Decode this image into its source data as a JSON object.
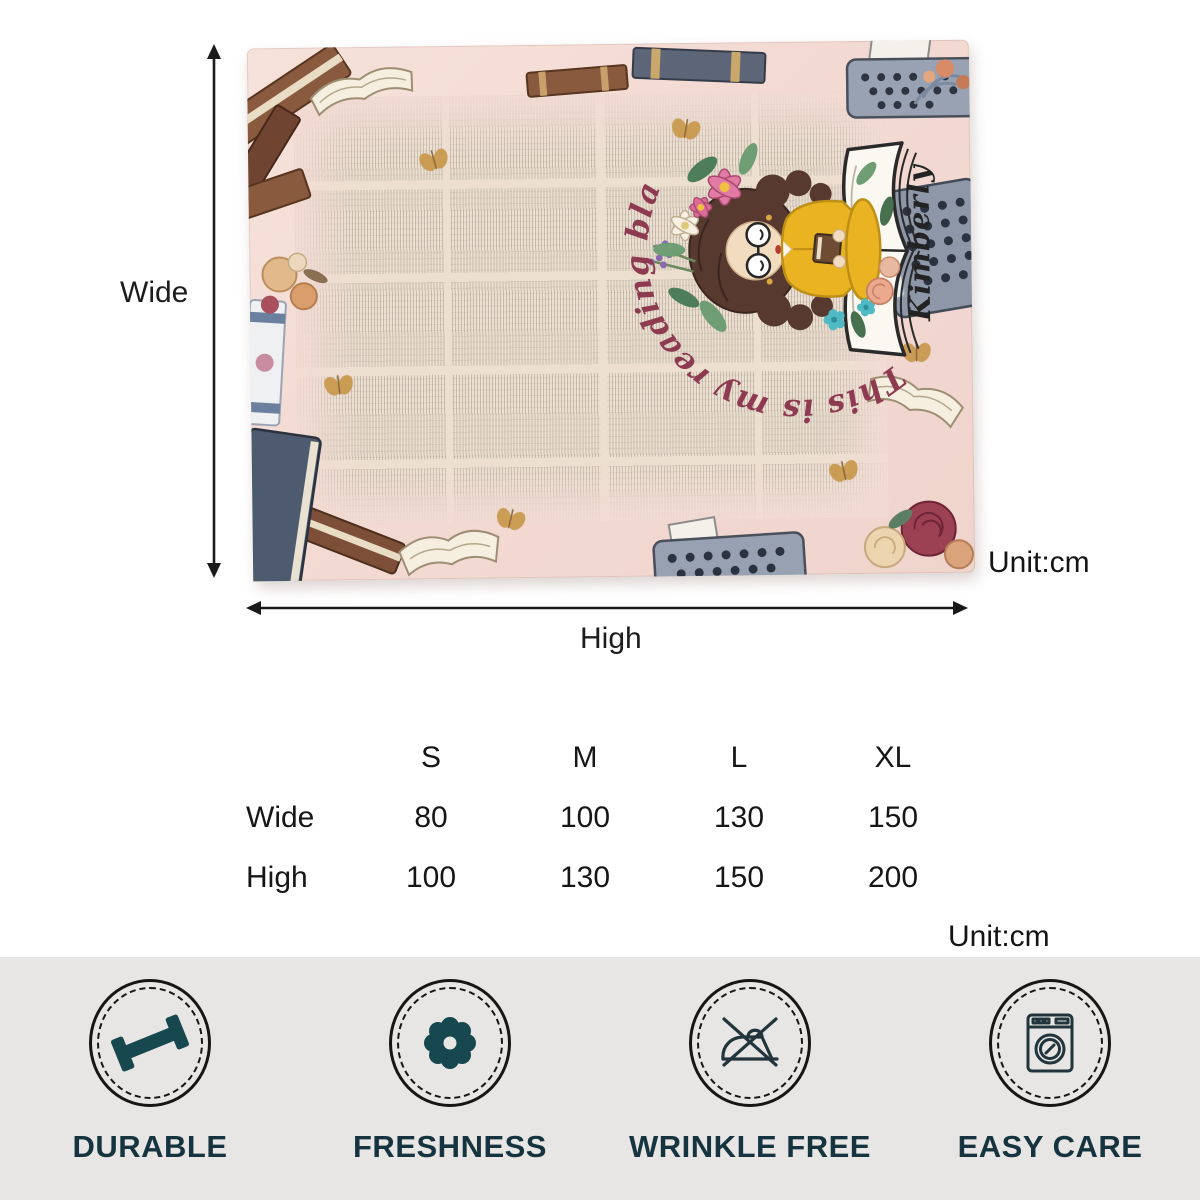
{
  "diagram": {
    "wide_label": "Wide",
    "high_label": "High",
    "unit_top": "Unit:cm",
    "unit_bottom": "Unit:cm",
    "blanket": {
      "arc_text": "This is my reading blanket",
      "name_text": "Kimberly",
      "motifs": [
        "vintage dictionary print",
        "books",
        "typewriters",
        "roses",
        "butterflies",
        "girl reading on open book"
      ]
    }
  },
  "size_table": {
    "columns": [
      "S",
      "M",
      "L",
      "XL"
    ],
    "rows": [
      {
        "label": "Wide",
        "values": [
          "80",
          "100",
          "130",
          "150"
        ]
      },
      {
        "label": "High",
        "values": [
          "100",
          "130",
          "150",
          "200"
        ]
      }
    ]
  },
  "features": [
    {
      "label": "DURABLE",
      "icon": "dumbbell-icon"
    },
    {
      "label": "FRESHNESS",
      "icon": "flower-icon"
    },
    {
      "label": "WRINKLE FREE",
      "icon": "no-iron-icon"
    },
    {
      "label": "EASY CARE",
      "icon": "washing-machine-icon"
    }
  ],
  "colors": {
    "arc_text": "#8e3b52",
    "name_text": "#232323",
    "blanket_pink": "#f3dbd4",
    "paper": "#eadfd1",
    "bar_background": "#e7e6e4",
    "feature_teal": "#17474f",
    "feature_label": "#16343f",
    "arrow_black": "#1a1a1a"
  }
}
